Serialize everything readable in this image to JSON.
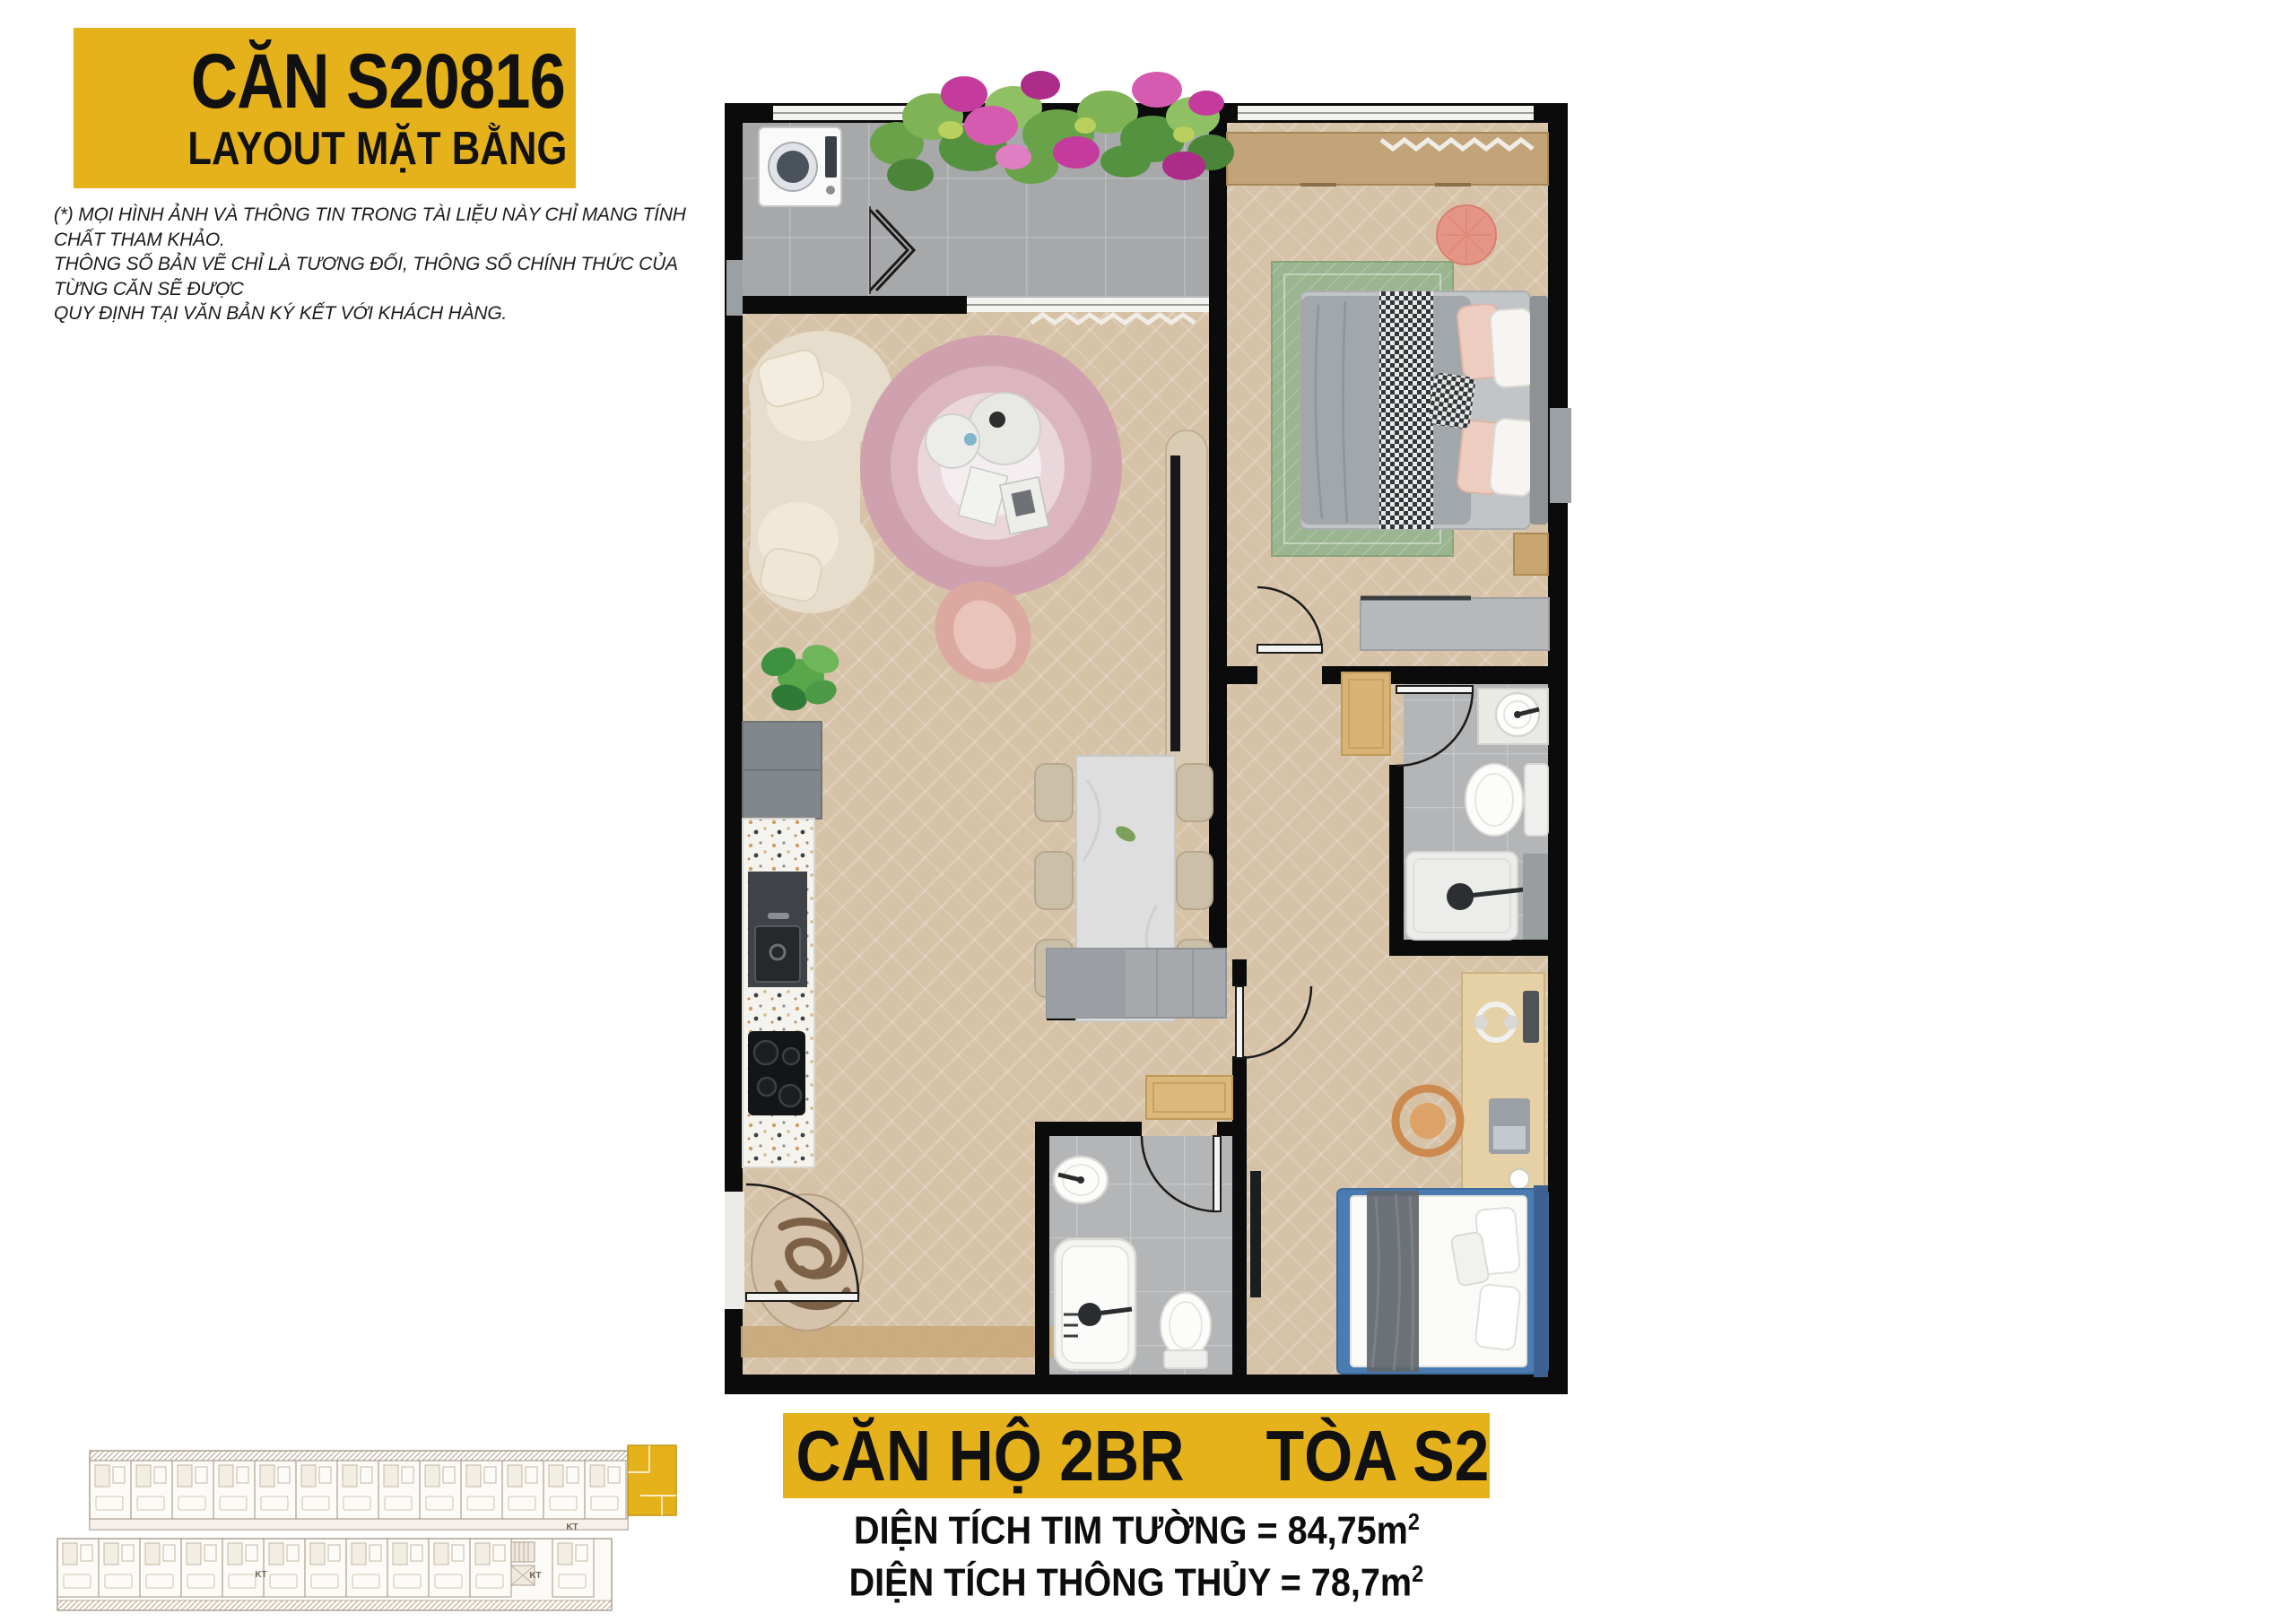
{
  "header": {
    "unit_code": "CĂN S20816",
    "subtitle": "LAYOUT MẶT BẰNG"
  },
  "disclaimer": [
    "(*) MỌI HÌNH ẢNH VÀ THÔNG TIN TRONG TÀI LIỆU NÀY CHỈ MANG TÍNH CHẤT THAM KHẢO.",
    "THÔNG SỐ BẢN VẼ CHỈ LÀ TƯƠNG ĐỐI, THÔNG SỐ CHÍNH THỨC CỦA TỪNG CĂN SẼ ĐƯỢC",
    "QUY ĐỊNH TẠI VĂN BẢN KÝ KẾT VỚI KHÁCH HÀNG."
  ],
  "footer": {
    "unit_type": "CĂN HỘ 2BR",
    "tower": "TÒA S2",
    "area_line1": "DIỆN TÍCH TIM TƯỜNG = 84,75m",
    "area_line2": "DIỆN TÍCH THÔNG THỦY = 78,7m",
    "sup": "2"
  },
  "keyplan": {
    "kt_labels": [
      "KT",
      "KT",
      "KT"
    ]
  },
  "colors": {
    "accent_yellow": "#E5B21C",
    "wall_black": "#0B0B0B",
    "wood_floor": "#D6C2A7",
    "balcony_tile": "#A7A8AA",
    "bath_tile": "#B3B5B7",
    "rug_green": "#9CB591",
    "rug_pink": "#CFA0AD",
    "sofa_cream": "#E6DDCC",
    "bed_blue": "#4A7CB1",
    "flower_magenta": "#C43B9D",
    "leaf_green": "#6AA24A"
  }
}
